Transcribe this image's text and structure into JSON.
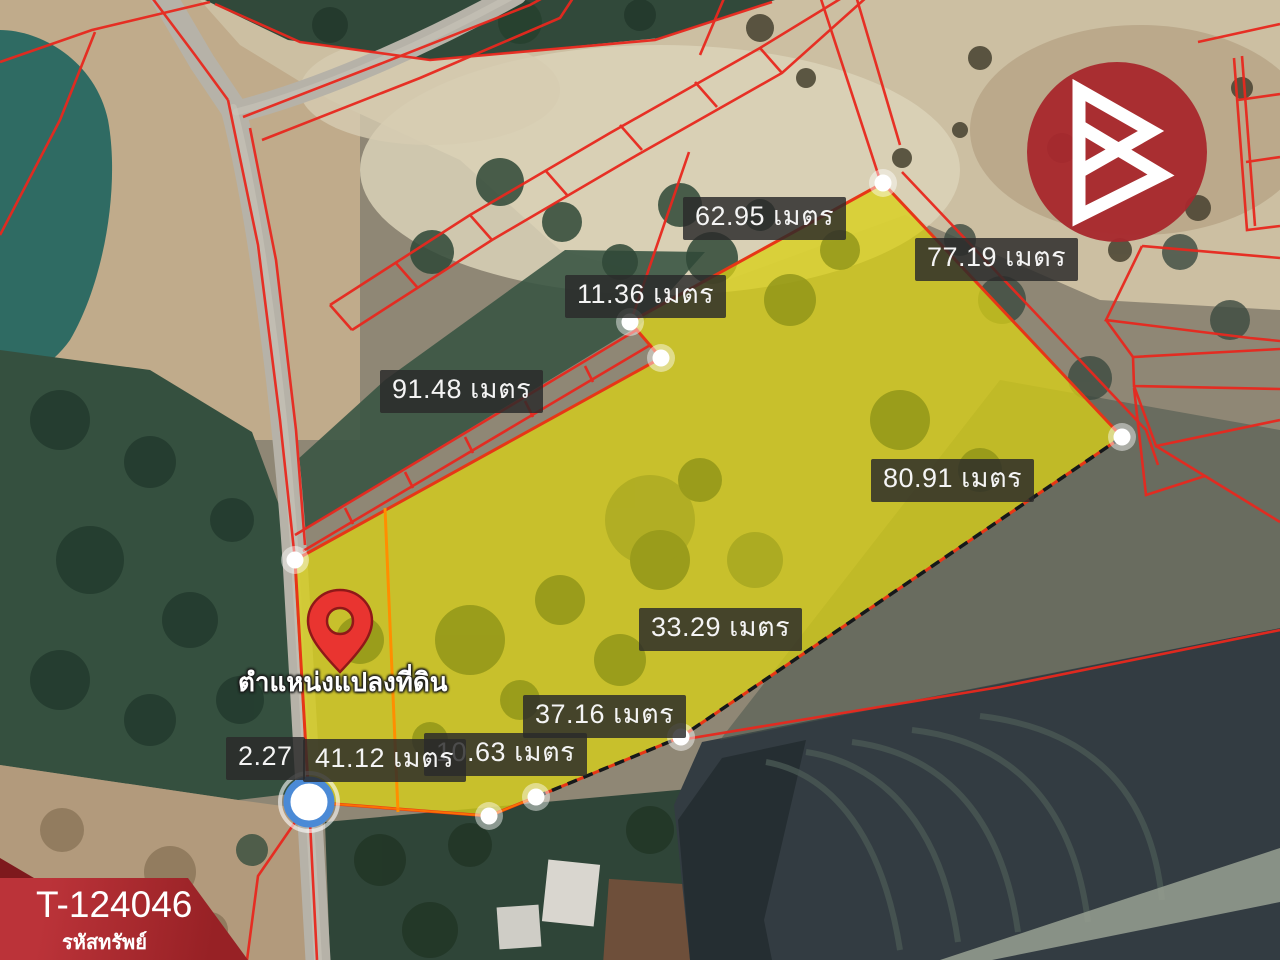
{
  "map": {
    "pin_label": "ตำแหน่งแปลงที่ดิน",
    "measurements": {
      "m1": "62.95 เมตร",
      "m2": "77.19 เมตร",
      "m3": "11.36 เมตร",
      "m4": "91.48 เมตร",
      "m5": "80.91 เมตร",
      "m6": "33.29 เมตร",
      "m7": "37.16 เมตร",
      "m8": "2.27",
      "m9": "10.63 เมตร",
      "m10": "41.12 เมตร"
    }
  },
  "badge": {
    "property_code": "T-124046",
    "caption": "รหัสทรัพย์"
  },
  "colors": {
    "accent_red": "#e8281e",
    "plot_yellow": "#d8cf17",
    "plot_border": "#e73616",
    "logo_red": "#a8292e",
    "label_bg": "rgba(42,42,42,0.83)"
  }
}
